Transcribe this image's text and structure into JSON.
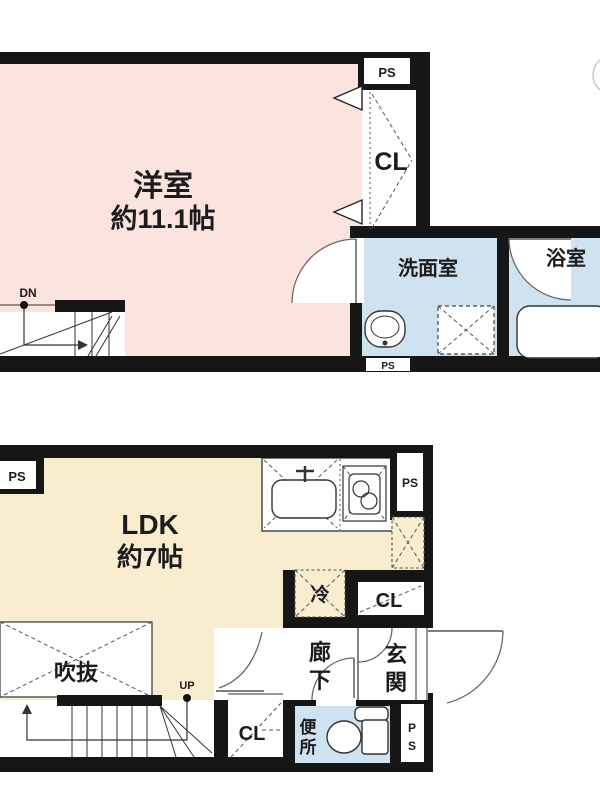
{
  "title": "floor-plan",
  "colors": {
    "bedroom_pink": "#fbe4dd",
    "ldk_cream": "#f8edcf",
    "water_blue": "#cfe2f0",
    "wall_black": "#161616"
  },
  "floor2": {
    "bedroom": "洋室",
    "bedroom_size": "約11.1帖",
    "closet": "CL",
    "washroom": "洗面室",
    "bathroom": "浴室",
    "ps_top": "PS",
    "ps_bottom": "PS",
    "down": "DN"
  },
  "floor1": {
    "ldk": "LDK",
    "ldk_size": "約7帖",
    "void": "吹抜",
    "up": "UP",
    "fridge": "冷",
    "closet_mid": "CL",
    "closet_bottom": "CL",
    "ps_top_left": "PS",
    "ps_top_right": "PS",
    "corridor": [
      "廊",
      "下"
    ],
    "entrance": [
      "玄",
      "関"
    ],
    "toilet": [
      "便",
      "所"
    ],
    "ps_bottom_right": [
      "P",
      "S"
    ]
  }
}
